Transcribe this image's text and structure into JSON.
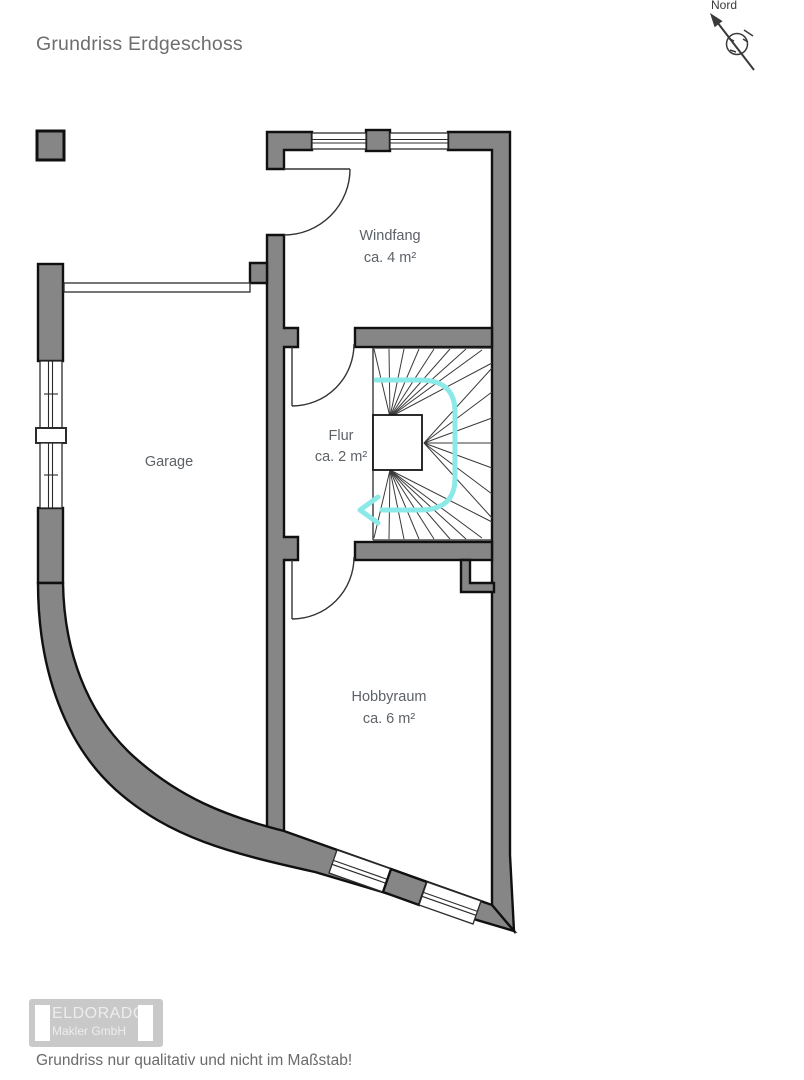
{
  "page": {
    "title": "Grundriss Erdgeschoss",
    "footer_note": "Grundriss nur qualitativ und nicht im Maßstab!"
  },
  "compass": {
    "label": "Nord"
  },
  "rooms": {
    "windfang": {
      "name": "Windfang",
      "area": "ca. 4 m²"
    },
    "garage": {
      "name": "Garage"
    },
    "flur": {
      "name": "Flur",
      "area": "ca. 2 m²"
    },
    "hobbyraum": {
      "name": "Hobbyraum",
      "area": "ca. 6 m²"
    }
  },
  "logo": {
    "line1": "ELDORADO",
    "line2": "Makler GmbH"
  },
  "colors": {
    "wall_fill": "#868686",
    "wall_outline": "#101010",
    "stair_arrow": "#8BE9E7",
    "label_text": "#5d6267",
    "title_text": "#6e6e6e"
  }
}
